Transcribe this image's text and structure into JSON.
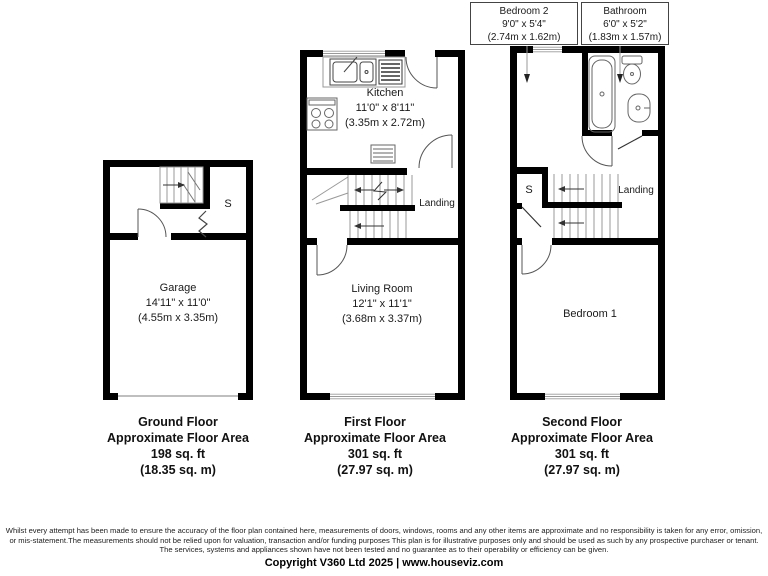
{
  "callouts": {
    "bedroom2": {
      "name": "Bedroom 2",
      "dims_imperial": "9'0\" x 5'4\"",
      "dims_metric": "(2.74m x 1.62m)"
    },
    "bathroom": {
      "name": "Bathroom",
      "dims_imperial": "6'0\" x 5'2\"",
      "dims_metric": "(1.83m x 1.57m)"
    }
  },
  "ground_floor": {
    "garage": {
      "name": "Garage",
      "dims_imperial": "14'11\" x 11'0\"",
      "dims_metric": "(4.55m x 3.35m)"
    },
    "store_label": "S",
    "summary": {
      "title": "Ground Floor",
      "subtitle": "Approximate Floor Area",
      "area_imperial": "198 sq. ft",
      "area_metric": "(18.35 sq. m)"
    }
  },
  "first_floor": {
    "kitchen": {
      "name": "Kitchen",
      "dims_imperial": "11'0\" x 8'11\"",
      "dims_metric": "(3.35m x 2.72m)"
    },
    "living_room": {
      "name": "Living Room",
      "dims_imperial": "12'1\" x 11'1\"",
      "dims_metric": "(3.68m x 3.37m)"
    },
    "landing_label": "Landing",
    "summary": {
      "title": "First Floor",
      "subtitle": "Approximate Floor Area",
      "area_imperial": "301 sq. ft",
      "area_metric": "(27.97 sq. m)"
    }
  },
  "second_floor": {
    "bedroom1": {
      "name": "Bedroom 1"
    },
    "landing_label": "Landing",
    "store_label": "S",
    "summary": {
      "title": "Second Floor",
      "subtitle": "Approximate Floor Area",
      "area_imperial": "301 sq. ft",
      "area_metric": "(27.97 sq. m)"
    }
  },
  "footer": {
    "disclaimer_lines": [
      "Whilst every attempt has been made to ensure the accuracy of the floor plan contained here, measurements of doors, windows, rooms and any other items are approximate and no responsibility is taken for any error, omission,",
      "or mis-statement.The measurements should not be relied upon for valuation, transaction and/or funding purposes This plan is for illustrative purposes only and should be used as such by any prospective purchaser or tenant.",
      "The services, systems and appliances shown have not been tested and no guarantee as to their operability or efficiency can be given."
    ],
    "copyright": "Copyright V360 Ltd 2025 | www.houseviz.com"
  },
  "colors": {
    "wall": "#000000",
    "thin_line": "#999999",
    "fixture_line": "#555555"
  }
}
